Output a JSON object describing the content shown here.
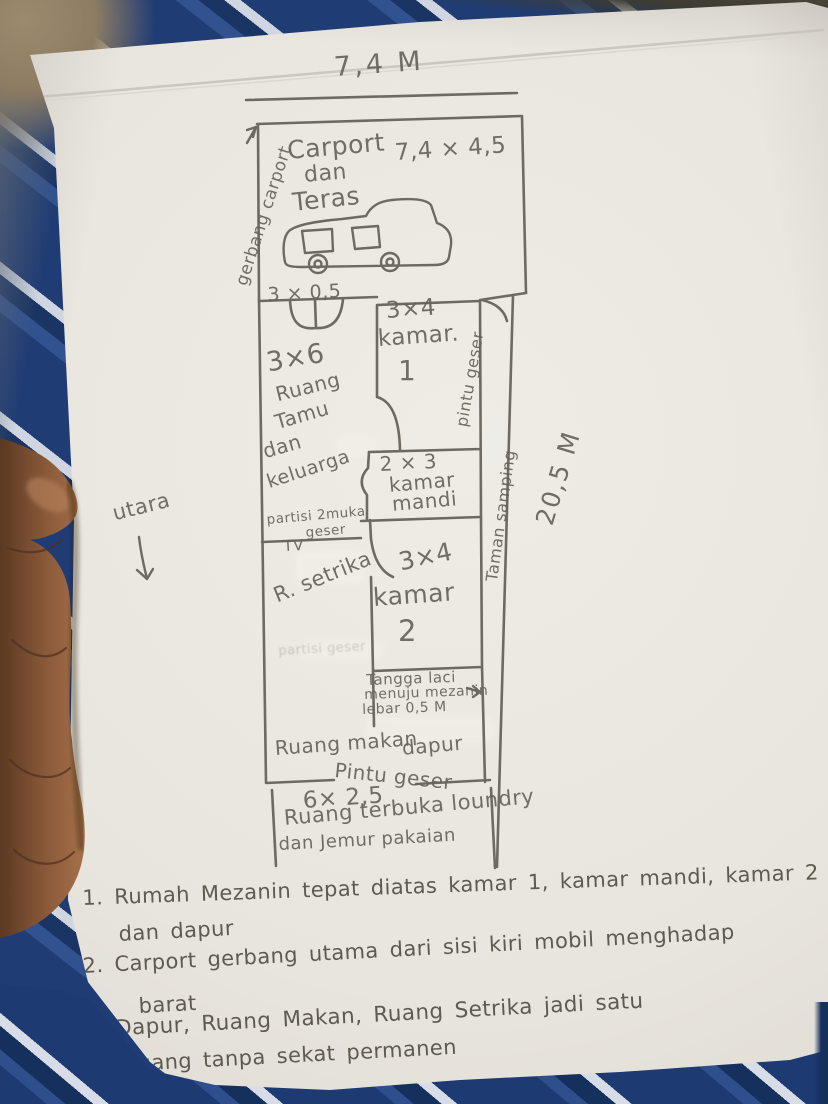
{
  "colors": {
    "paper": "#e9e6e0",
    "pencil": "#6e6a61",
    "fabric_navy": "#203c74",
    "fabric_stripe": "#cfd6e2",
    "table_tan": "#8d7c62",
    "skin": "#8a5a3a"
  },
  "plan": {
    "dimensions": {
      "top": "7,4 M",
      "side": "20,5 M"
    },
    "compass": {
      "label": "utara"
    },
    "carport": {
      "gate_label": "gerbang carport",
      "name_line1": "Carport",
      "name_line2": "dan",
      "name_line3": "Teras",
      "size": "7,4 × 4,5"
    },
    "front_door_size": "3 × 0,5",
    "living_room": {
      "size": "3×6",
      "line1": "Ruang",
      "line2": "Tamu",
      "line3": "dan",
      "line4": "keluarga"
    },
    "bedroom1": {
      "size": "3×4",
      "name": "kamar.",
      "number": "1",
      "side_door": "pintu geser"
    },
    "bathroom": {
      "size": "2 × 3",
      "line1": "kamar",
      "line2": "mandi"
    },
    "side_garden": "Taman samping",
    "partition": {
      "line1": "partisi 2muka",
      "line2": "geser",
      "erased": "partisi geser"
    },
    "tv_label": "TV",
    "ironing_room": "R. setrika",
    "bedroom2": {
      "size": "3×4",
      "name": "kamar",
      "number": "2"
    },
    "mezzanine_stairs": {
      "line1": "Tangga laci",
      "line2": "menuju mezanin",
      "line3": "lebar 0,5 M"
    },
    "dining_room": "Ruang makan",
    "kitchen": "dapur",
    "bottom_door": "Pintu geser",
    "open_area": {
      "size": "6× 2,5",
      "line1": "Ruang terbuka loundry",
      "line2": "dan Jemur pakaian"
    }
  },
  "notes": [
    {
      "line1": "1. Rumah Mezanin tepat diatas kamar 1, kamar mandi, kamar 2",
      "line2": "dan dapur"
    },
    {
      "line1": "2. Carport gerbang utama dari sisi kiri mobil menghadap",
      "line2": "barat"
    },
    {
      "line1": "3. Dapur, Ruang Makan, Ruang Setrika jadi satu",
      "line2": "ruang tanpa sekat permanen"
    }
  ]
}
